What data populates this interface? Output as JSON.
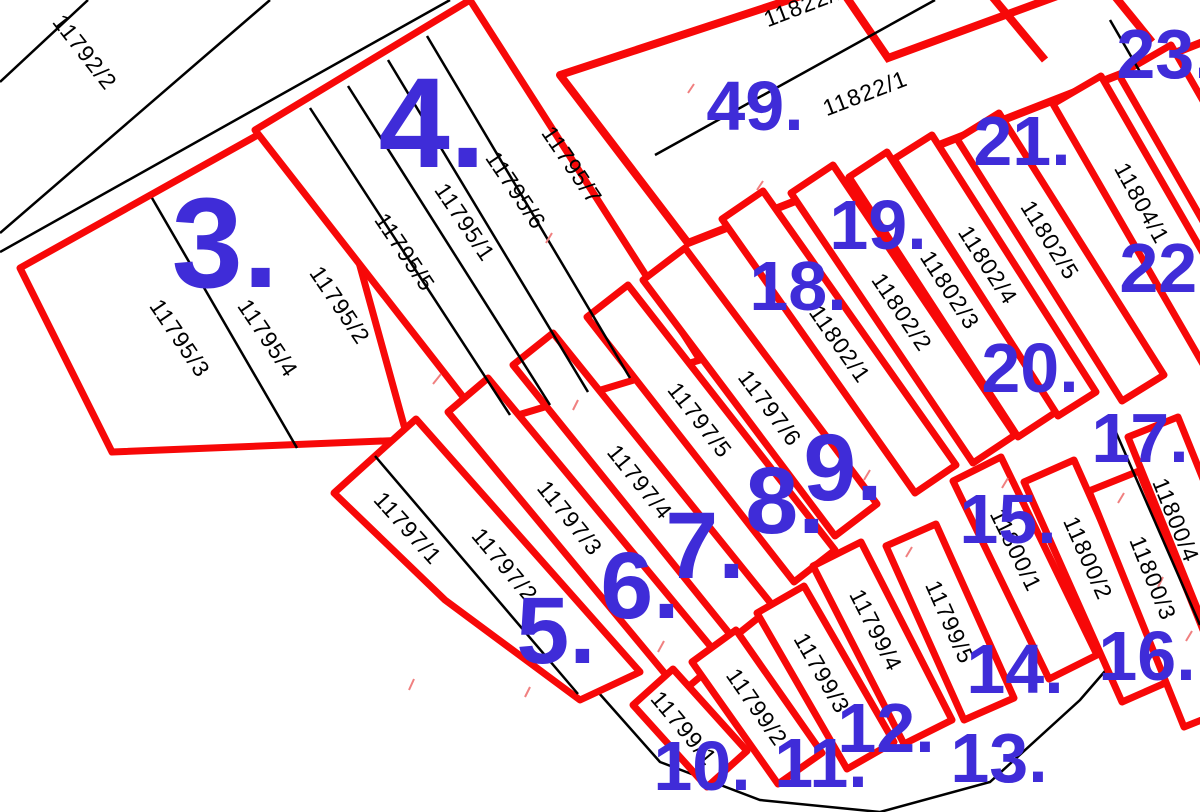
{
  "map": {
    "colors": {
      "background": "#ffffff",
      "highlight_outline": "#f70808",
      "boundary_line": "#000000",
      "area_label": "#3f2cd8",
      "artifact_tick": "#f08080"
    },
    "parcels": [
      "11792/2",
      "11795/3",
      "11795/4",
      "11795/2",
      "11795/5",
      "11795/1",
      "11795/6",
      "11795/7",
      "11822/2",
      "11822/1",
      "11797/1",
      "11797/2",
      "11797/3",
      "11797/4",
      "11797/5",
      "11797/6",
      "11802/1",
      "11802/2",
      "11802/3",
      "11802/4",
      "11802/5",
      "11804/1",
      "11799/1",
      "11799/2",
      "11799/3",
      "11799/4",
      "11799/5",
      "11800/1",
      "11800/2",
      "11800/3",
      "11800/4"
    ],
    "area_labels": [
      "3.",
      "4.",
      "5.",
      "6.",
      "7.",
      "8.",
      "9.",
      "10.",
      "11.",
      "12.",
      "13.",
      "14.",
      "15.",
      "16.",
      "17.",
      "18.",
      "19.",
      "20.",
      "21.",
      "22.",
      "23.",
      "49."
    ]
  }
}
